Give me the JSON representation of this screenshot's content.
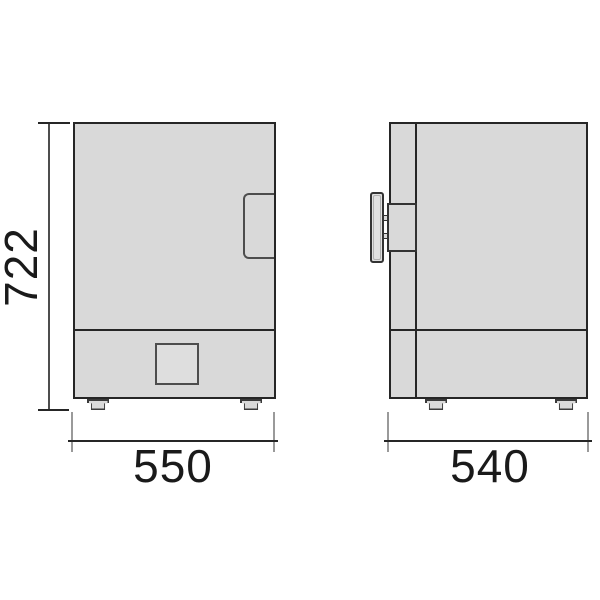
{
  "drawing": {
    "type": "technical-dimension-drawing",
    "subject": "boxy appliance (oven/incubator) front and side elevations",
    "dimensions": {
      "height": "722",
      "front_width": "550",
      "side_depth": "540"
    },
    "views": [
      {
        "name": "front-view",
        "features": [
          "door with right-edge recessed handle",
          "lower control panel with square window",
          "two feet"
        ]
      },
      {
        "name": "side-view",
        "features": [
          "protruding door handle bar with mount",
          "door edge line",
          "lower panel line",
          "two feet"
        ]
      }
    ],
    "colors": {
      "background": "#ffffff",
      "body_fill": "#d9d9d9",
      "outline": "#262626",
      "detail_line": "#4d4d4d",
      "extension_line": "#9a9a9a",
      "dimension_text": "#1a1a1a"
    }
  }
}
